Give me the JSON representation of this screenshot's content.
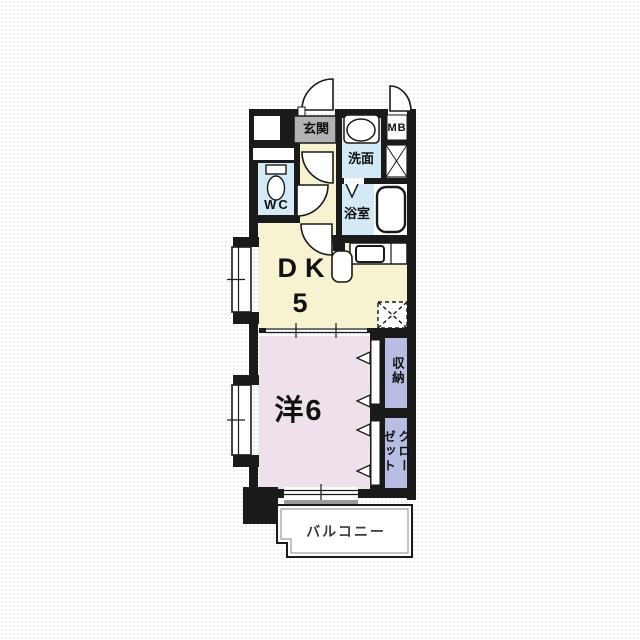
{
  "floorplan": {
    "rooms": {
      "genkan": "玄関",
      "senmen": "洗面",
      "mb": "MB",
      "wc": "WC",
      "yokushitsu": "浴室",
      "dk_label": "DK",
      "dk_size": "5",
      "western": "洋6",
      "shuno": "収納",
      "closet": "クローゼット",
      "balcony": "バルコニー"
    },
    "colors": {
      "wall": "#1a1a1a",
      "water_room": "#d3e9f5",
      "kitchen_floor": "#f7f2cf",
      "bedroom_floor": "#eee1eb",
      "storage": "#b9bde3",
      "entry_tile": "#b3b3b3",
      "balcony_fill": "#ffffff",
      "threshold_gray": "#9a9a9a"
    }
  }
}
